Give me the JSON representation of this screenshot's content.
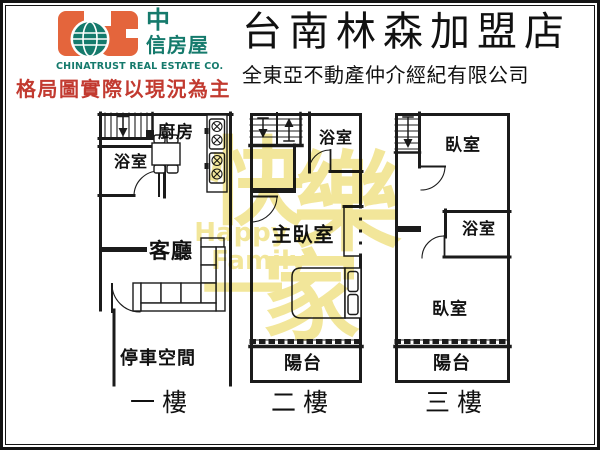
{
  "header": {
    "logo_cn_line1": "中",
    "logo_cn_line2": "信房屋",
    "logo_en": "CHINATRUST REAL ESTATE CO.",
    "disclaimer": "格局圖實際以現況為主",
    "title": "台南林森加盟店",
    "subtitle": "全東亞不動產仲介經紀有限公司"
  },
  "colors": {
    "logo_orange": "#e4653c",
    "logo_teal": "#157a6c",
    "disclaimer_red": "#c23a30",
    "wall_black": "#1b1b1b",
    "watermark_yellow": "#f1e38c"
  },
  "watermark": {
    "char1": "快",
    "char2": "樂",
    "char3": "一",
    "char4": "家",
    "en_line1": "Happy",
    "en_line2": "Family"
  },
  "floors": [
    {
      "name": "一樓",
      "rooms": {
        "kitchen": "廚房",
        "bath": "浴室",
        "living": "客廳",
        "parking": "停車空間"
      }
    },
    {
      "name": "二樓",
      "rooms": {
        "bath": "浴室",
        "master": "主臥室",
        "balcony": "陽台"
      }
    },
    {
      "name": "三樓",
      "rooms": {
        "bed1": "臥室",
        "bath": "浴室",
        "bed2": "臥室",
        "balcony": "陽台"
      }
    }
  ]
}
